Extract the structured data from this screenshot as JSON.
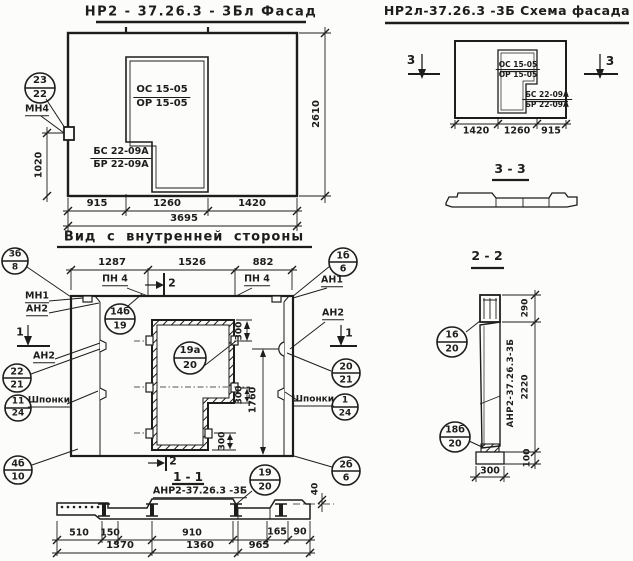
{
  "ink": "#1d1d1b",
  "facade": {
    "title": "НР2 - 37.26.3 - 3Бл Фасад",
    "callout": {
      "top": "23",
      "bottom": "22",
      "label": "МН4"
    },
    "opening_mark": {
      "top": "ОС 15-05",
      "bottom": "ОР 15-05"
    },
    "block_mark": {
      "top": "БС 22-09А",
      "bottom": "БР 22-09А"
    },
    "dim_left": "1020",
    "dim_right": "2610",
    "dims_bottom": [
      "915",
      "1260",
      "1420"
    ],
    "dim_total": "3695"
  },
  "schema": {
    "title": "НР2л-37.26.3 -3Б Схема фасада",
    "marker_left": "3",
    "marker_right": "3",
    "opening_mark": {
      "top": "ОС 15-05",
      "bottom": "ОР 15-05"
    },
    "block_mark": {
      "top": "БС 22-09А",
      "bottom": "БР 22-09А"
    },
    "dims_bottom": [
      "1420",
      "1260",
      "915"
    ]
  },
  "section33": {
    "title": "3 - 3"
  },
  "section22": {
    "title": "2 - 2",
    "panel_label": "АНР2-37.26.3-3Б",
    "callout_top": {
      "top": "16",
      "bottom": "20"
    },
    "callout_bottom": {
      "top": "18б",
      "bottom": "20"
    },
    "dim_top": "290",
    "dim_mid": "2220",
    "dim_bottom": "100",
    "dim_width": "300"
  },
  "inner": {
    "title": "Вид с внутренней стороны",
    "dims_top": [
      "1287",
      "1526",
      "882"
    ],
    "pn_left": "ПН 4",
    "pn_right": "ПН 4",
    "marker_2_top": "2",
    "marker_2_bottom": "2",
    "marker_1_left": "1",
    "marker_1_right": "1",
    "labels": {
      "mn1": "МН1",
      "an2_a": "АН2",
      "an2_b": "АН2",
      "an1": "АН1",
      "an2_c": "АН2",
      "shponki_left": "Шпонки",
      "shponki_right": "Шпонки"
    },
    "callouts": {
      "top_left": {
        "top": "3б",
        "bottom": "8"
      },
      "top_right": {
        "top": "1б",
        "bottom": "6"
      },
      "mid_left": {
        "top": "14б",
        "bottom": "19"
      },
      "left1": {
        "top": "22",
        "bottom": "21"
      },
      "left2": {
        "top": "11",
        "bottom": "24"
      },
      "bottom_left": {
        "top": "4б",
        "bottom": "10"
      },
      "opening": {
        "top": "19а",
        "bottom": "20"
      },
      "right1": {
        "top": "20",
        "bottom": "21"
      },
      "right2": {
        "top": "1",
        "bottom": "24"
      },
      "bottom_right": {
        "top": "2б",
        "bottom": "6"
      }
    },
    "dim_300_1": "300",
    "dim_300_2": "300",
    "dim_300_3": "300",
    "dim_1760": "1760"
  },
  "section11": {
    "title": "1 - 1",
    "marker": "2",
    "label": "АНР2-37.26.3 -3Б",
    "callout": {
      "top": "19",
      "bottom": "20"
    },
    "dim_40": "40",
    "dims_row1": [
      "510",
      "150",
      "910",
      "165",
      "90"
    ],
    "dims_row2": [
      "1370",
      "1360",
      "965"
    ]
  }
}
